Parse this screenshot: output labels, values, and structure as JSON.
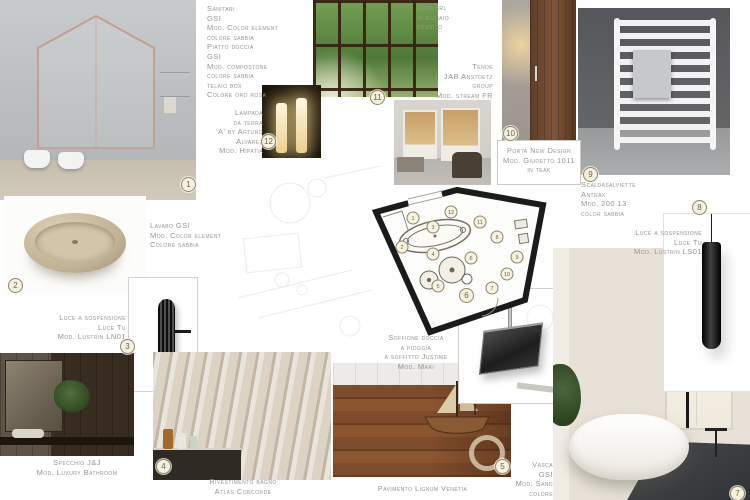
{
  "labels": {
    "sanitari": {
      "text": "Sanitari\nGSI\nMod. Color element\ncolore sabbia\nPiatto doccia\nGSI\nMod. compostone\ncolore sabbia\ntelaio box\nColore oro rosa"
    },
    "cima": {
      "text": "Cima srl\nin acciaio\nbrunito"
    },
    "tende": {
      "text": "Tende\nJAB Anstoetz\ngroup\nMod. stream FR"
    },
    "porta": {
      "text": "Porta New Design\nMod. Giudetto 1011\nin teak"
    },
    "scaldasalviette": {
      "text": "Scaldasalviette\nAntrax\nMod. 200 13\ncolor sabbia"
    },
    "luce_dx": {
      "text": "Luce a sospensione\nLuce Tu\nMod. Lustrin LS01"
    },
    "lampada": {
      "text": "Lampada\nda terra\n'A' by Arturo\nAlvarez\nMod. Hipatia"
    },
    "lavabo": {
      "text": "Lavabo GSI\nMod. Color element\nColore sabbia"
    },
    "luce_sx": {
      "text": "Luce a sospensione\nLuce Tu\nMod. Lustrin LN01"
    },
    "specchio": {
      "text": "Specchio J&J\nMod. Luxury Bathroom"
    },
    "rivestimento": {
      "text": "Rivestimento bagno\nAtlas Concorde"
    },
    "pavimento": {
      "text": "Pavimento Lignum Venetia"
    },
    "soffione": {
      "text": "Soffione doccia\na pioggia\na soffitto Justime\nMod. Mari"
    },
    "vasca": {
      "text": "Vasca\nGSI\nMod. Sand\ncolore"
    }
  },
  "badges": [
    "1",
    "2",
    "3",
    "4",
    "5",
    "6",
    "7",
    "8",
    "9",
    "10",
    "11",
    "12"
  ],
  "plan": {
    "circles": [
      {
        "n": "1",
        "x": 183,
        "y": 70
      },
      {
        "n": "12",
        "x": 221,
        "y": 64
      },
      {
        "n": "11",
        "x": 250,
        "y": 74
      },
      {
        "n": "2",
        "x": 172,
        "y": 99
      },
      {
        "n": "3",
        "x": 203,
        "y": 79
      },
      {
        "n": "4",
        "x": 203,
        "y": 106
      },
      {
        "n": "8",
        "x": 267,
        "y": 89
      },
      {
        "n": "9",
        "x": 287,
        "y": 109
      },
      {
        "n": "6",
        "x": 241,
        "y": 110
      },
      {
        "n": "5",
        "x": 208,
        "y": 138
      },
      {
        "n": "7",
        "x": 262,
        "y": 140
      },
      {
        "n": "10",
        "x": 277,
        "y": 126
      }
    ]
  },
  "colors": {
    "sand": "#cbbfa8",
    "rose_gold": "#c79d90",
    "walnut": "#6e4a30",
    "forest_green": "#50793a",
    "charcoal": "#2b2e30"
  }
}
